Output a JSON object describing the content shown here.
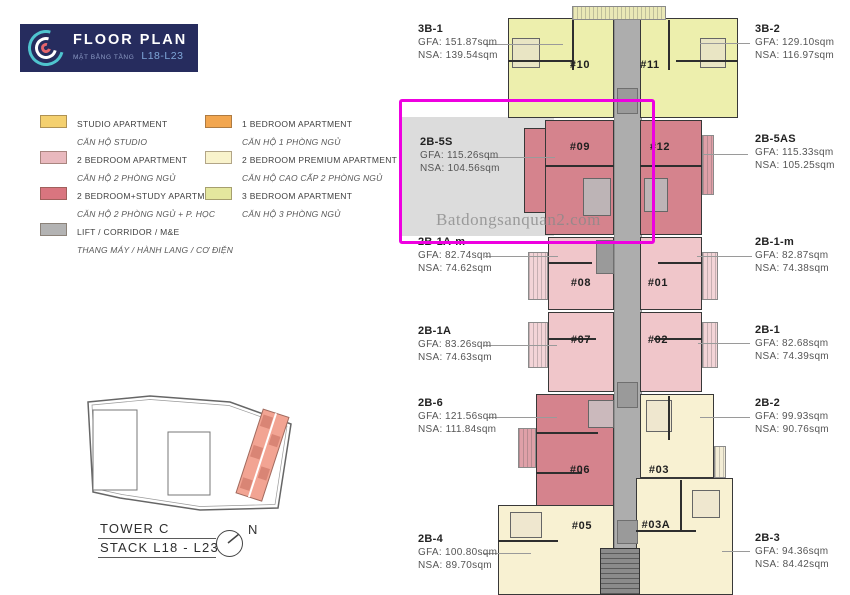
{
  "header": {
    "title": "FLOOR PLAN",
    "subtitle_vi": "MẶT BẰNG TẦNG",
    "levels": "L18-L23"
  },
  "legend": {
    "items": [
      {
        "name": "STUDIO APARTMENT",
        "name_vi": "CĂN HỘ STUDIO",
        "color": "#F4D06F"
      },
      {
        "name": "1 BEDROOM APARTMENT",
        "name_vi": "CĂN HỘ 1 PHÒNG NGỦ",
        "color": "#F2A64F"
      },
      {
        "name": "2 BEDROOM APARTMENT",
        "name_vi": "CĂN HỘ 2 PHÒNG NGỦ",
        "color": "#E9B9BE"
      },
      {
        "name": "2 BEDROOM PREMIUM APARTMENT",
        "name_vi": "CĂN HỘ CAO CẤP 2 PHÒNG NGỦ",
        "color": "#F9F3CC"
      },
      {
        "name": "2 BEDROOM+STUDY APARTMENT",
        "name_vi": "CĂN HỘ 2 PHÒNG NGỦ + P. HỌC",
        "color": "#D9757F"
      },
      {
        "name": "3 BEDROOM APARTMENT",
        "name_vi": "CĂN HỘ 3 PHÒNG NGỦ",
        "color": "#E4E79E"
      },
      {
        "name": "LIFT / CORRIDOR / M&E",
        "name_vi": "THANG MÁY / HÀNH LANG / CƠ ĐIỆN",
        "color": "#B3B3B3"
      }
    ]
  },
  "site": {
    "tower": "TOWER C",
    "stack": "STACK L18 - L23",
    "compass": "N",
    "tower_color": "#F2A493"
  },
  "watermark": {
    "text": "Batdongsanquan2.com"
  },
  "highlight": {
    "unit_code": "2B-5S",
    "color": "#EE00E0"
  },
  "colors": {
    "three_br": "#EDEFAD",
    "two_br": "#F0C6CA",
    "two_br_study": "#D5838D",
    "premium": "#F8F1D2",
    "corridor": "#ADADAD"
  },
  "plan": {
    "units": [
      {
        "number": "#10"
      },
      {
        "number": "#11"
      },
      {
        "number": "#09"
      },
      {
        "number": "#12"
      },
      {
        "number": "#08"
      },
      {
        "number": "#01"
      },
      {
        "number": "#07"
      },
      {
        "number": "#02"
      },
      {
        "number": "#06"
      },
      {
        "number": "#03"
      },
      {
        "number": "#05"
      },
      {
        "number": "#03A"
      }
    ]
  },
  "left_labels": [
    {
      "code": "3B-1",
      "gfa": "GFA: 151.87sqm",
      "nsa": "NSA: 139.54sqm"
    },
    {
      "code": "2B-5S",
      "gfa": "GFA: 115.26sqm",
      "nsa": "NSA: 104.56sqm"
    },
    {
      "code": "2B-1A-m",
      "gfa": "GFA: 82.74sqm",
      "nsa": "NSA: 74.62sqm"
    },
    {
      "code": "2B-1A",
      "gfa": "GFA: 83.26sqm",
      "nsa": "NSA: 74.63sqm"
    },
    {
      "code": "2B-6",
      "gfa": "GFA: 121.56sqm",
      "nsa": "NSA: 111.84sqm"
    },
    {
      "code": "2B-4",
      "gfa": "GFA: 100.80sqm",
      "nsa": "NSA: 89.70sqm"
    }
  ],
  "right_labels": [
    {
      "code": "3B-2",
      "gfa": "GFA: 129.10sqm",
      "nsa": "NSA: 116.97sqm"
    },
    {
      "code": "2B-5AS",
      "gfa": "GFA: 115.33sqm",
      "nsa": "NSA: 105.25sqm"
    },
    {
      "code": "2B-1-m",
      "gfa": "GFA: 82.87sqm",
      "nsa": "NSA: 74.38sqm"
    },
    {
      "code": "2B-1",
      "gfa": "GFA: 82.68sqm",
      "nsa": "NSA: 74.39sqm"
    },
    {
      "code": "2B-2",
      "gfa": "GFA: 99.93sqm",
      "nsa": "NSA: 90.76sqm"
    },
    {
      "code": "2B-3",
      "gfa": "GFA: 94.36sqm",
      "nsa": "NSA: 84.42sqm"
    }
  ]
}
